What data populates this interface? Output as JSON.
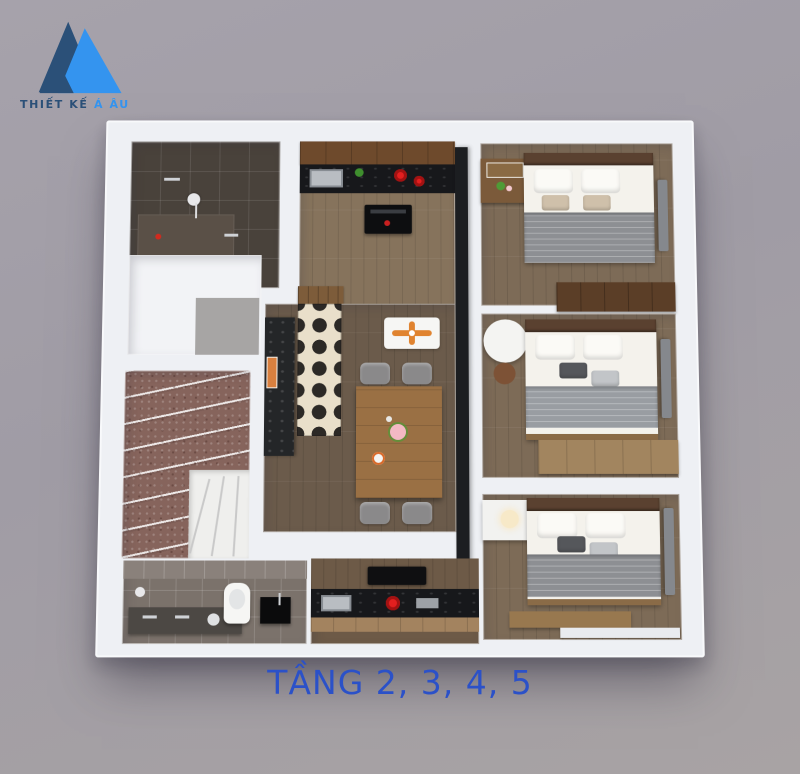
{
  "logo": {
    "brand_primary": "THIẾT KẾ",
    "brand_accent": "Á ÂU",
    "colors": {
      "navy": "#2b5078",
      "blue": "#3494ef"
    }
  },
  "caption": {
    "text": "TẦNG 2, 3, 4, 5",
    "color": "#2b51c8"
  },
  "palette": {
    "background": "#a29ea7",
    "wall_white": "#eef0f4",
    "wood_floor": "#7d6b57",
    "dining_wood": "#6b5b4b",
    "cabinet_wood": "#6e4a2c",
    "counter_black_marble": "#17181b",
    "stair_granite": "#86645c",
    "tile_cream": "#e9dfca",
    "tile_black": "#2c2926",
    "bath_dark_tile": "#49423b",
    "bath_gray_tile": "#7b726b",
    "burner_red": "#e31f1f",
    "duvet_gray": "#8d8f93",
    "fan_orange": "#e0832f",
    "tv_gray": "#85888d"
  },
  "icons": {
    "logo_mark": "twin-mountain-triangles",
    "ceiling_fan": "four-blade-fan",
    "shower": "shower-head",
    "stove": "red-burner-rings",
    "toilet": "toilet-top-view"
  }
}
